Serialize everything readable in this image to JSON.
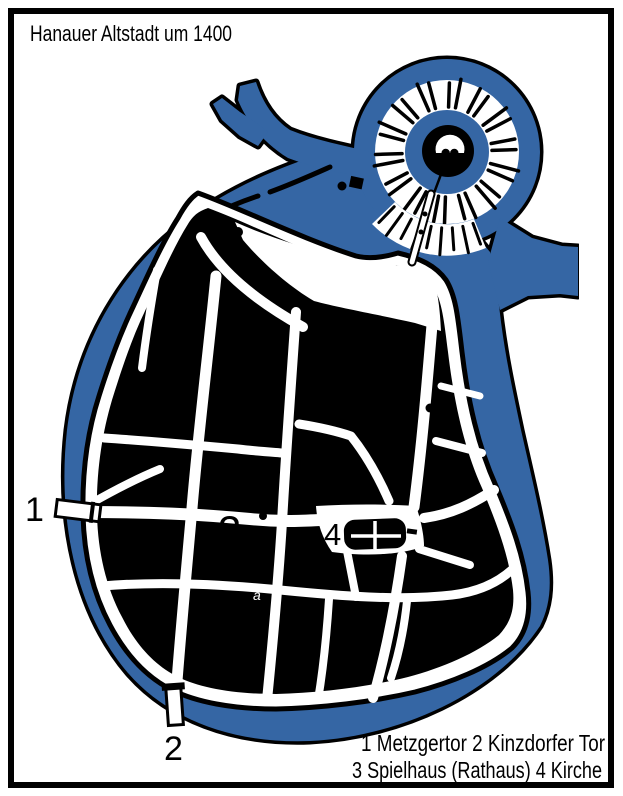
{
  "map": {
    "title": "Hanauer Altstadt um 1400",
    "legend": {
      "line1": "1 Metzgertor 2 Kinzdorfer Tor",
      "line2": "3 Spielhaus (Rathaus) 4 Kirche"
    },
    "markers": [
      {
        "num": "1",
        "name": "Metzgertor"
      },
      {
        "num": "2",
        "name": "Kinzdorfer Tor"
      },
      {
        "num": "3",
        "name": "Spielhaus (Rathaus)"
      },
      {
        "num": "4",
        "name": "Kirche"
      }
    ],
    "annotation_a": "a",
    "colors": {
      "water": "#3566A4",
      "ink": "#000000",
      "paper": "#ffffff"
    }
  }
}
